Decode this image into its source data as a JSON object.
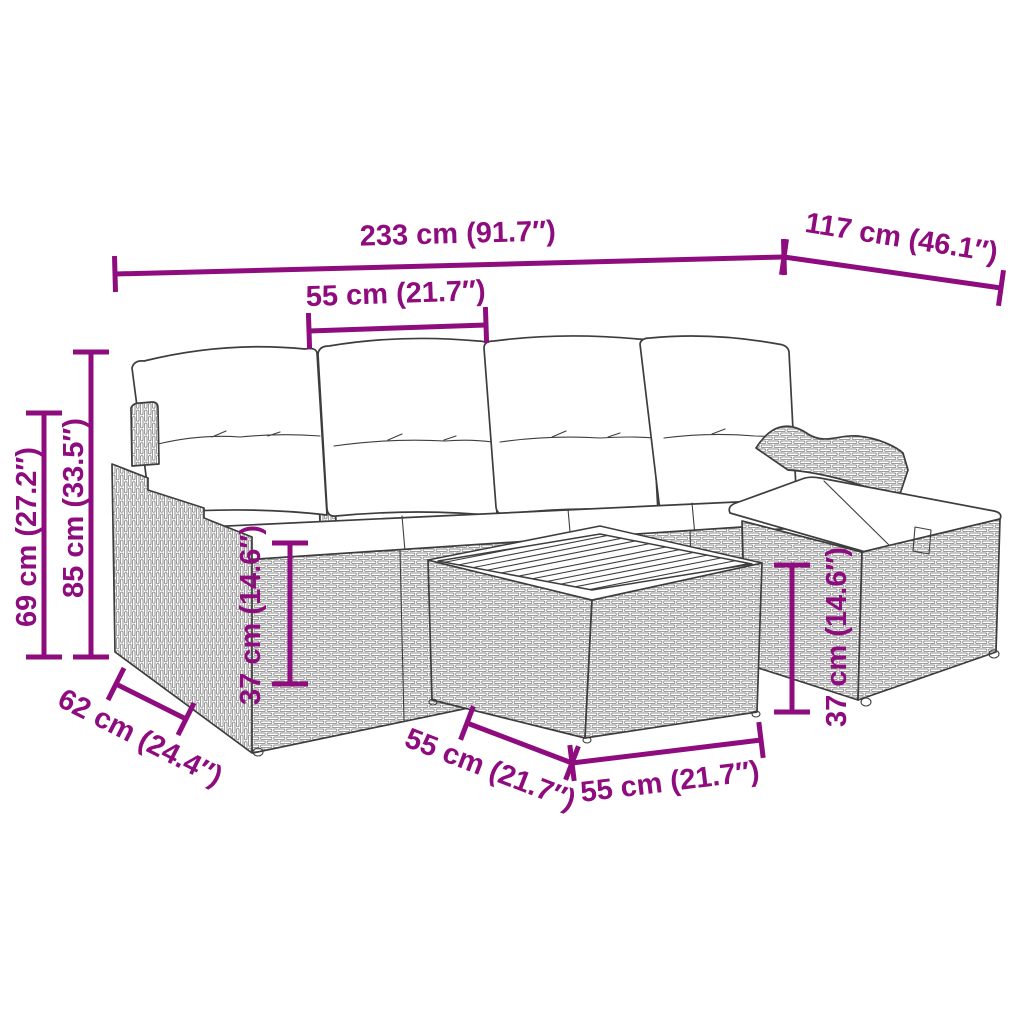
{
  "drawing": {
    "subject": "poly rattan garden lounge set line drawing: 4-seat modular sofa with back and seat cushions, stepped left armrest, curved right armrest, corner ottoman with cushion, square side table with slatted wood top",
    "line_color": "#3d3d3d",
    "cushion_color": "#ffffff",
    "background": "#ffffff"
  },
  "dimension_color": "#8e0c7e",
  "dims": {
    "d233": "233 cm (91.7″)",
    "d117": "117 cm (46.1″)",
    "d55_top": "55 cm (21.7″)",
    "d69": "69 cm (27.2″)",
    "d85": "85 cm (33.5″)",
    "d37_left": "37 cm (14.6″)",
    "d37_right": "37 cm (14.6″)",
    "d62": "62 cm (24.4″)",
    "d55_front_left": "55 cm (21.7″)",
    "d55_front": "55 cm (21.7″)"
  }
}
